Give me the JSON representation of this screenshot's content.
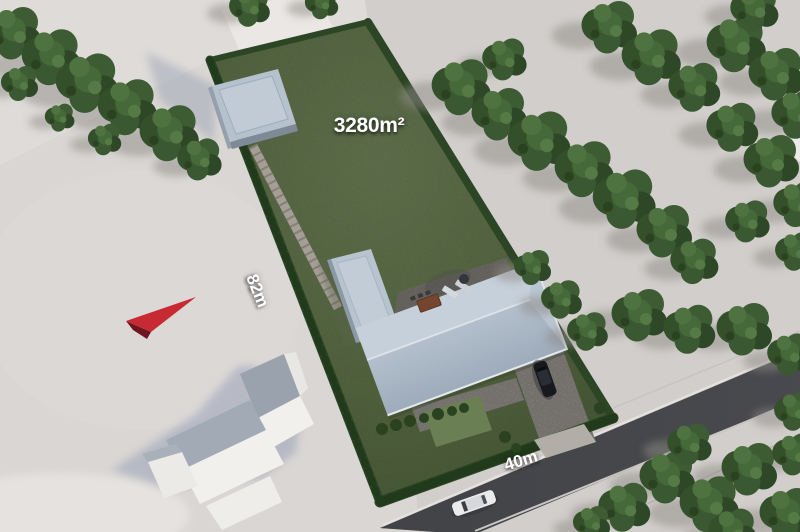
{
  "labels": {
    "area": "3280m²",
    "side": "82m",
    "front": "40m"
  },
  "colors": {
    "ground": "#d9d6d3",
    "ground_east": "#d1cecb",
    "ground_nw": "#dedbd8",
    "grass": "#6a8054",
    "hedge": "#2c4524",
    "hedge_dark": "#203a1b",
    "roof_flat": "#b7c3cf",
    "roof_upper": "#c6d0da",
    "roof_lower": "#a9b6c4",
    "garage_roof": "#b5c2ce",
    "road": "#46474b",
    "driveway": "#b2ada6",
    "patio": "#8f8b85",
    "path": "#a09a92",
    "arrow": "#c82a33",
    "arrow_shade": "#6e1620",
    "car_black": "#17191e",
    "car_white": "#ebebed",
    "building_white": "#f2f0ed"
  }
}
